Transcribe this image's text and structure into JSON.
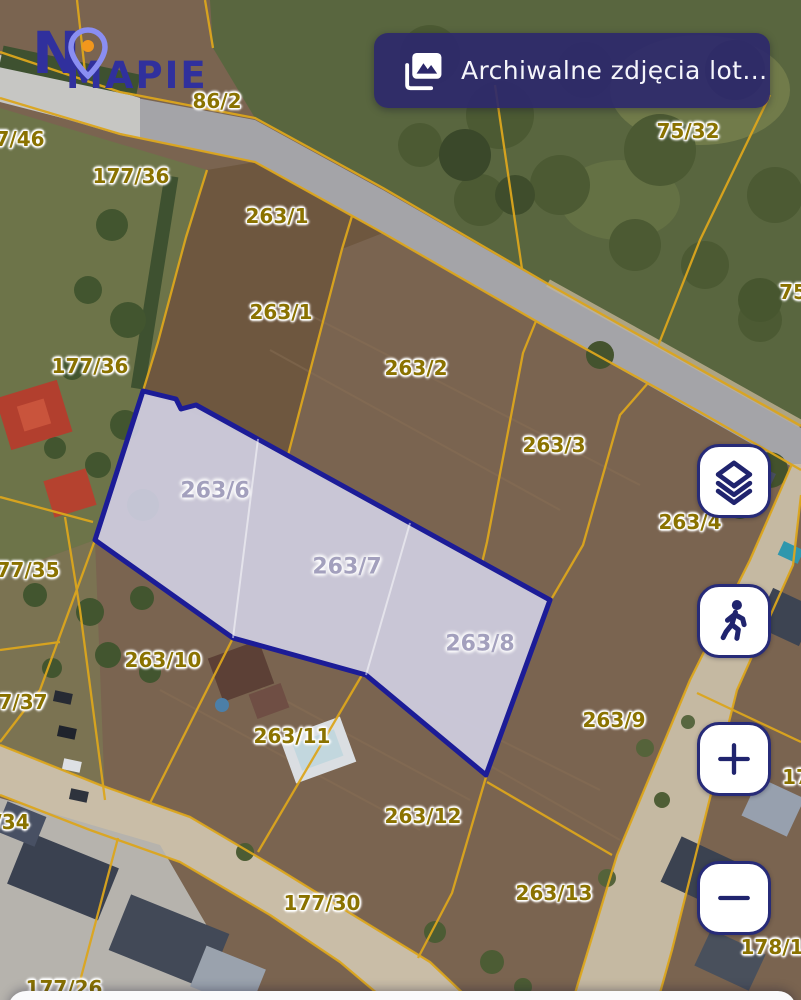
{
  "app": {
    "logo_line1": "N",
    "logo_line2": "MAPIE",
    "logo_colors": {
      "text": "#30309d",
      "pin_outline": "#8a8ef2",
      "pin_dot": "#f2971c"
    }
  },
  "header_button": {
    "label": "Archiwalne zdjęcia lot...",
    "icon": "photo-archive-icon",
    "background": "#2c286b"
  },
  "controls": [
    {
      "id": "layers",
      "icon": "layers-icon"
    },
    {
      "id": "street-view",
      "icon": "pedestrian-icon"
    },
    {
      "id": "zoom-in",
      "icon": "plus-icon"
    },
    {
      "id": "zoom-out",
      "icon": "minus-icon"
    }
  ],
  "map": {
    "selected_parcels": [
      "263/6",
      "263/7",
      "263/8"
    ],
    "colors": {
      "parcel_line": "#dca61d",
      "parcel_label": "#8a7200",
      "selected_fill": "#cfcee1",
      "selected_border": "#1c1c97",
      "selected_label": "#a3a0bd"
    },
    "labels": [
      {
        "text": "86/2",
        "x": 217,
        "y": 101,
        "kind": "parcel"
      },
      {
        "text": "75/32",
        "x": 688,
        "y": 131,
        "kind": "parcel"
      },
      {
        "text": "75",
        "x": 793,
        "y": 292,
        "kind": "parcel"
      },
      {
        "text": "7/46",
        "x": 20,
        "y": 139,
        "kind": "parcel"
      },
      {
        "text": "177/36",
        "x": 131,
        "y": 176,
        "kind": "parcel"
      },
      {
        "text": "263/1",
        "x": 277,
        "y": 216,
        "kind": "parcel"
      },
      {
        "text": "263/1",
        "x": 281,
        "y": 312,
        "kind": "parcel"
      },
      {
        "text": "177/36",
        "x": 90,
        "y": 366,
        "kind": "parcel"
      },
      {
        "text": "263/2",
        "x": 416,
        "y": 368,
        "kind": "parcel"
      },
      {
        "text": "263/3",
        "x": 554,
        "y": 445,
        "kind": "parcel"
      },
      {
        "text": "263/4",
        "x": 690,
        "y": 522,
        "kind": "parcel"
      },
      {
        "text": "77/35",
        "x": 28,
        "y": 570,
        "kind": "parcel"
      },
      {
        "text": "263/6",
        "x": 215,
        "y": 491,
        "kind": "selected"
      },
      {
        "text": "263/7",
        "x": 347,
        "y": 567,
        "kind": "selected"
      },
      {
        "text": "263/8",
        "x": 480,
        "y": 644,
        "kind": "selected"
      },
      {
        "text": "263/10",
        "x": 163,
        "y": 660,
        "kind": "parcel"
      },
      {
        "text": "7/37",
        "x": 23,
        "y": 702,
        "kind": "parcel"
      },
      {
        "text": "263/11",
        "x": 292,
        "y": 736,
        "kind": "parcel"
      },
      {
        "text": "263/9",
        "x": 614,
        "y": 720,
        "kind": "parcel"
      },
      {
        "text": "263/12",
        "x": 423,
        "y": 816,
        "kind": "parcel"
      },
      {
        "text": "/34",
        "x": 12,
        "y": 822,
        "kind": "parcel"
      },
      {
        "text": "17",
        "x": 796,
        "y": 777,
        "kind": "parcel"
      },
      {
        "text": "263/13",
        "x": 554,
        "y": 893,
        "kind": "parcel"
      },
      {
        "text": "177/30",
        "x": 322,
        "y": 903,
        "kind": "parcel"
      },
      {
        "text": "178/1",
        "x": 772,
        "y": 947,
        "kind": "parcel"
      },
      {
        "text": "177/26",
        "x": 64,
        "y": 988,
        "kind": "parcel"
      }
    ]
  }
}
